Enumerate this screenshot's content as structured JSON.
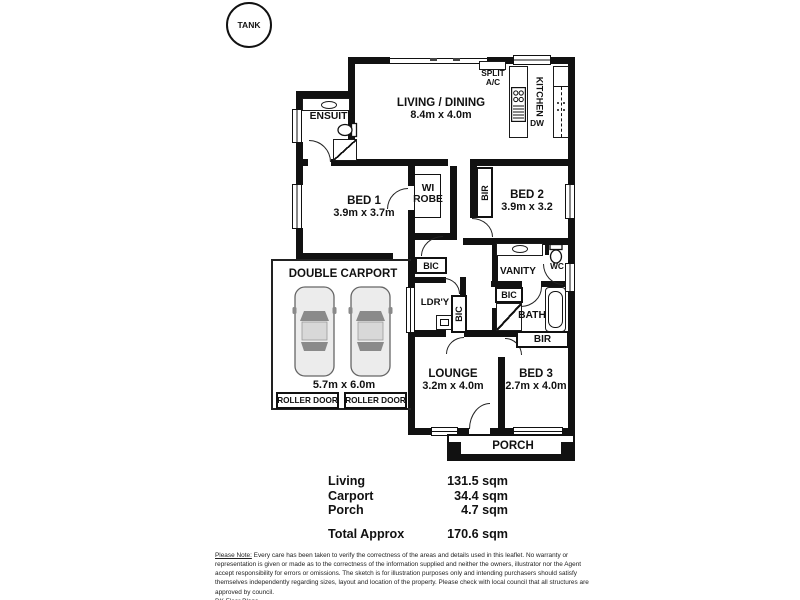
{
  "plan": {
    "tank_label": "TANK",
    "rooms": {
      "living": {
        "name": "LIVING / DINING",
        "dims": "8.4m x 4.0m"
      },
      "kitchen": {
        "name": "KITCHEN",
        "dw": "DW",
        "split_ac_line1": "SPLIT",
        "split_ac_line2": "A/C"
      },
      "ensuite": {
        "name": "ENSUITE"
      },
      "bed1": {
        "name": "BED 1",
        "dims": "3.9m x 3.7m"
      },
      "wirobe": {
        "line1": "WI",
        "line2": "ROBE"
      },
      "bed2": {
        "name": "BED 2",
        "dims": "3.9m x 3.2",
        "bir": "BIR"
      },
      "vanity": {
        "name": "VANITY",
        "wc": "WC"
      },
      "hall": {
        "bic": "BIC"
      },
      "laundry": {
        "name": "LDR'Y",
        "bic": "BIC"
      },
      "bath": {
        "name": "BATH",
        "bic": "BIC"
      },
      "lounge": {
        "name": "LOUNGE",
        "dims": "3.2m x 4.0m"
      },
      "bed3": {
        "name": "BED 3",
        "dims": "2.7m x 4.0m",
        "bir": "BIR"
      },
      "porch": {
        "name": "PORCH"
      },
      "carport": {
        "name": "DOUBLE CARPORT",
        "dims": "5.7m x 6.0m",
        "roller_door_left": "ROLLER DOOR",
        "roller_door_right": "ROLLER DOOR"
      }
    }
  },
  "summary": {
    "rows": [
      {
        "label": "Living",
        "value": "131.5 sqm"
      },
      {
        "label": "Carport",
        "value": "34.4 sqm"
      },
      {
        "label": "Porch",
        "value": "4.7 sqm"
      }
    ],
    "total": {
      "label": "Total Approx",
      "value": "170.6 sqm"
    }
  },
  "disclaimer": {
    "note_label": "Please Note:",
    "text": " Every care has been taken to verify the correctness of the areas and details used in this leaflet. No warranty or representation is given or made as to the correctness of the information supplied and neither the owners, illustrator nor the Agent accept responsibility for errors or omissions. The sketch is for illustration purposes only and intending purchasers should satisfy themselves independently regarding sizes, layout and location of the property. Please check with local council that all structures are approved by council.",
    "brand": "DK Floor Plans"
  },
  "colors": {
    "wall": "#111111",
    "background": "#ffffff",
    "car_body": "#ececec",
    "car_glass": "#8a8a8a"
  }
}
